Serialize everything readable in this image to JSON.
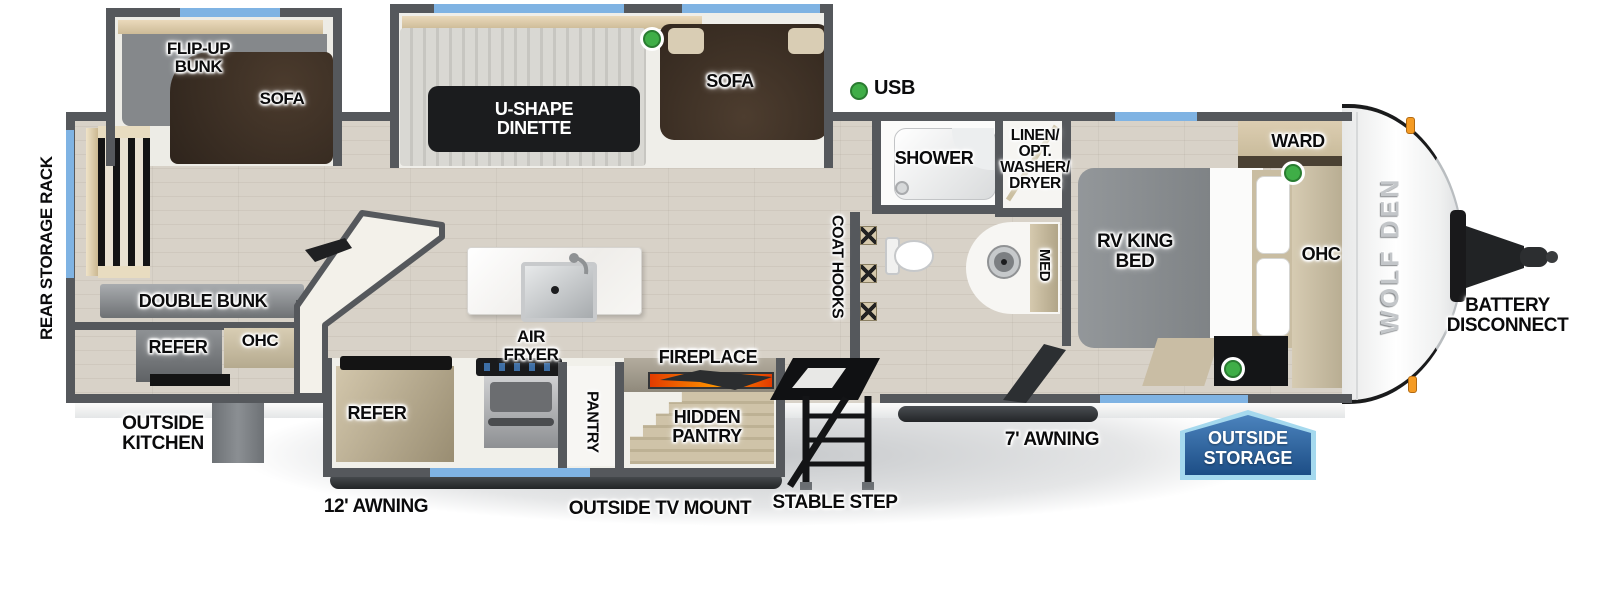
{
  "plan": {
    "slideout_bunk": {
      "flip_up_bunk": "FLIP-UP BUNK",
      "sofa": "SOFA"
    },
    "slideout_living": {
      "dinette": "U-SHAPE DINETTE",
      "sofa": "SOFA"
    },
    "kitchen": {
      "refer": "REFER",
      "air_fryer": "AIR FRYER",
      "pantry": "PANTRY",
      "fireplace": "FIREPLACE",
      "hidden_pantry": "HIDDEN PANTRY"
    },
    "bunk_room": {
      "double_bunk": "DOUBLE BUNK",
      "refer": "REFER",
      "ohc": "OHC"
    },
    "bath": {
      "shower": "SHOWER",
      "linen_opt": "LINEN/ OPT. WASHER/ DRYER",
      "med": "MED",
      "coat_hooks": "COAT HOOKS"
    },
    "bedroom": {
      "bed": "RV KING BED",
      "ward": "WARD",
      "ohc": "OHC"
    },
    "exterior": {
      "rear_storage_rack": "REAR STORAGE RACK",
      "outside_kitchen": "OUTSIDE KITCHEN",
      "awning_12": "12' AWNING",
      "outside_tv_mount": "OUTSIDE TV MOUNT",
      "stable_step": "STABLE STEP",
      "awning_7": "7' AWNING",
      "outside_storage": "OUTSIDE STORAGE",
      "usb": "USB",
      "battery_disconnect": "BATTERY DISCONNECT",
      "brand_logo": "WOLF DEN"
    },
    "colors": {
      "wall": "#55585c",
      "floor": "#d8d2c8",
      "window_blue": "#7fb3e3",
      "indicator_green": "#3fae47",
      "sofa_brown": "#42342a",
      "cabinet_tan": "#cdc2ab",
      "fireplace_orange": "#ff8800",
      "badge_blue": "#2b63a3",
      "badge_border": "#a5d9ee"
    }
  }
}
